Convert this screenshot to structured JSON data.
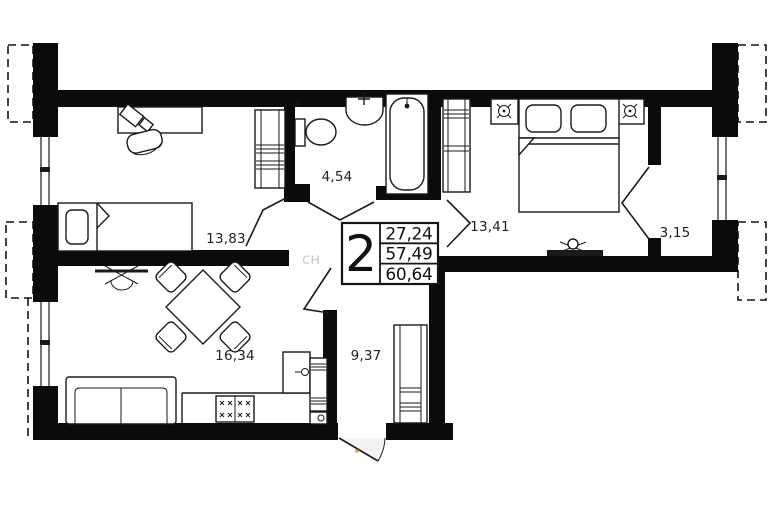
{
  "plan": {
    "summary": {
      "rooms_count": "2",
      "living_area": "27,24",
      "apartment_area": "57,49",
      "total_area": "60,64"
    },
    "rooms": [
      {
        "name": "room",
        "area": "13,83"
      },
      {
        "name": "bathroom",
        "area": "4,54"
      },
      {
        "name": "bedroom",
        "area": "13,41"
      },
      {
        "name": "balcony",
        "area": "3,15"
      },
      {
        "name": "kitchen-living-room",
        "area": "16,34"
      },
      {
        "name": "hallway",
        "area": "9,37"
      }
    ],
    "watermark": "сн",
    "colors": {
      "walls": "#0b0b0b",
      "lines": "#1a1a1a",
      "background": "#ffffff",
      "entry_door_handle": "#e8963c",
      "watermark": "#c9c9c9"
    }
  }
}
